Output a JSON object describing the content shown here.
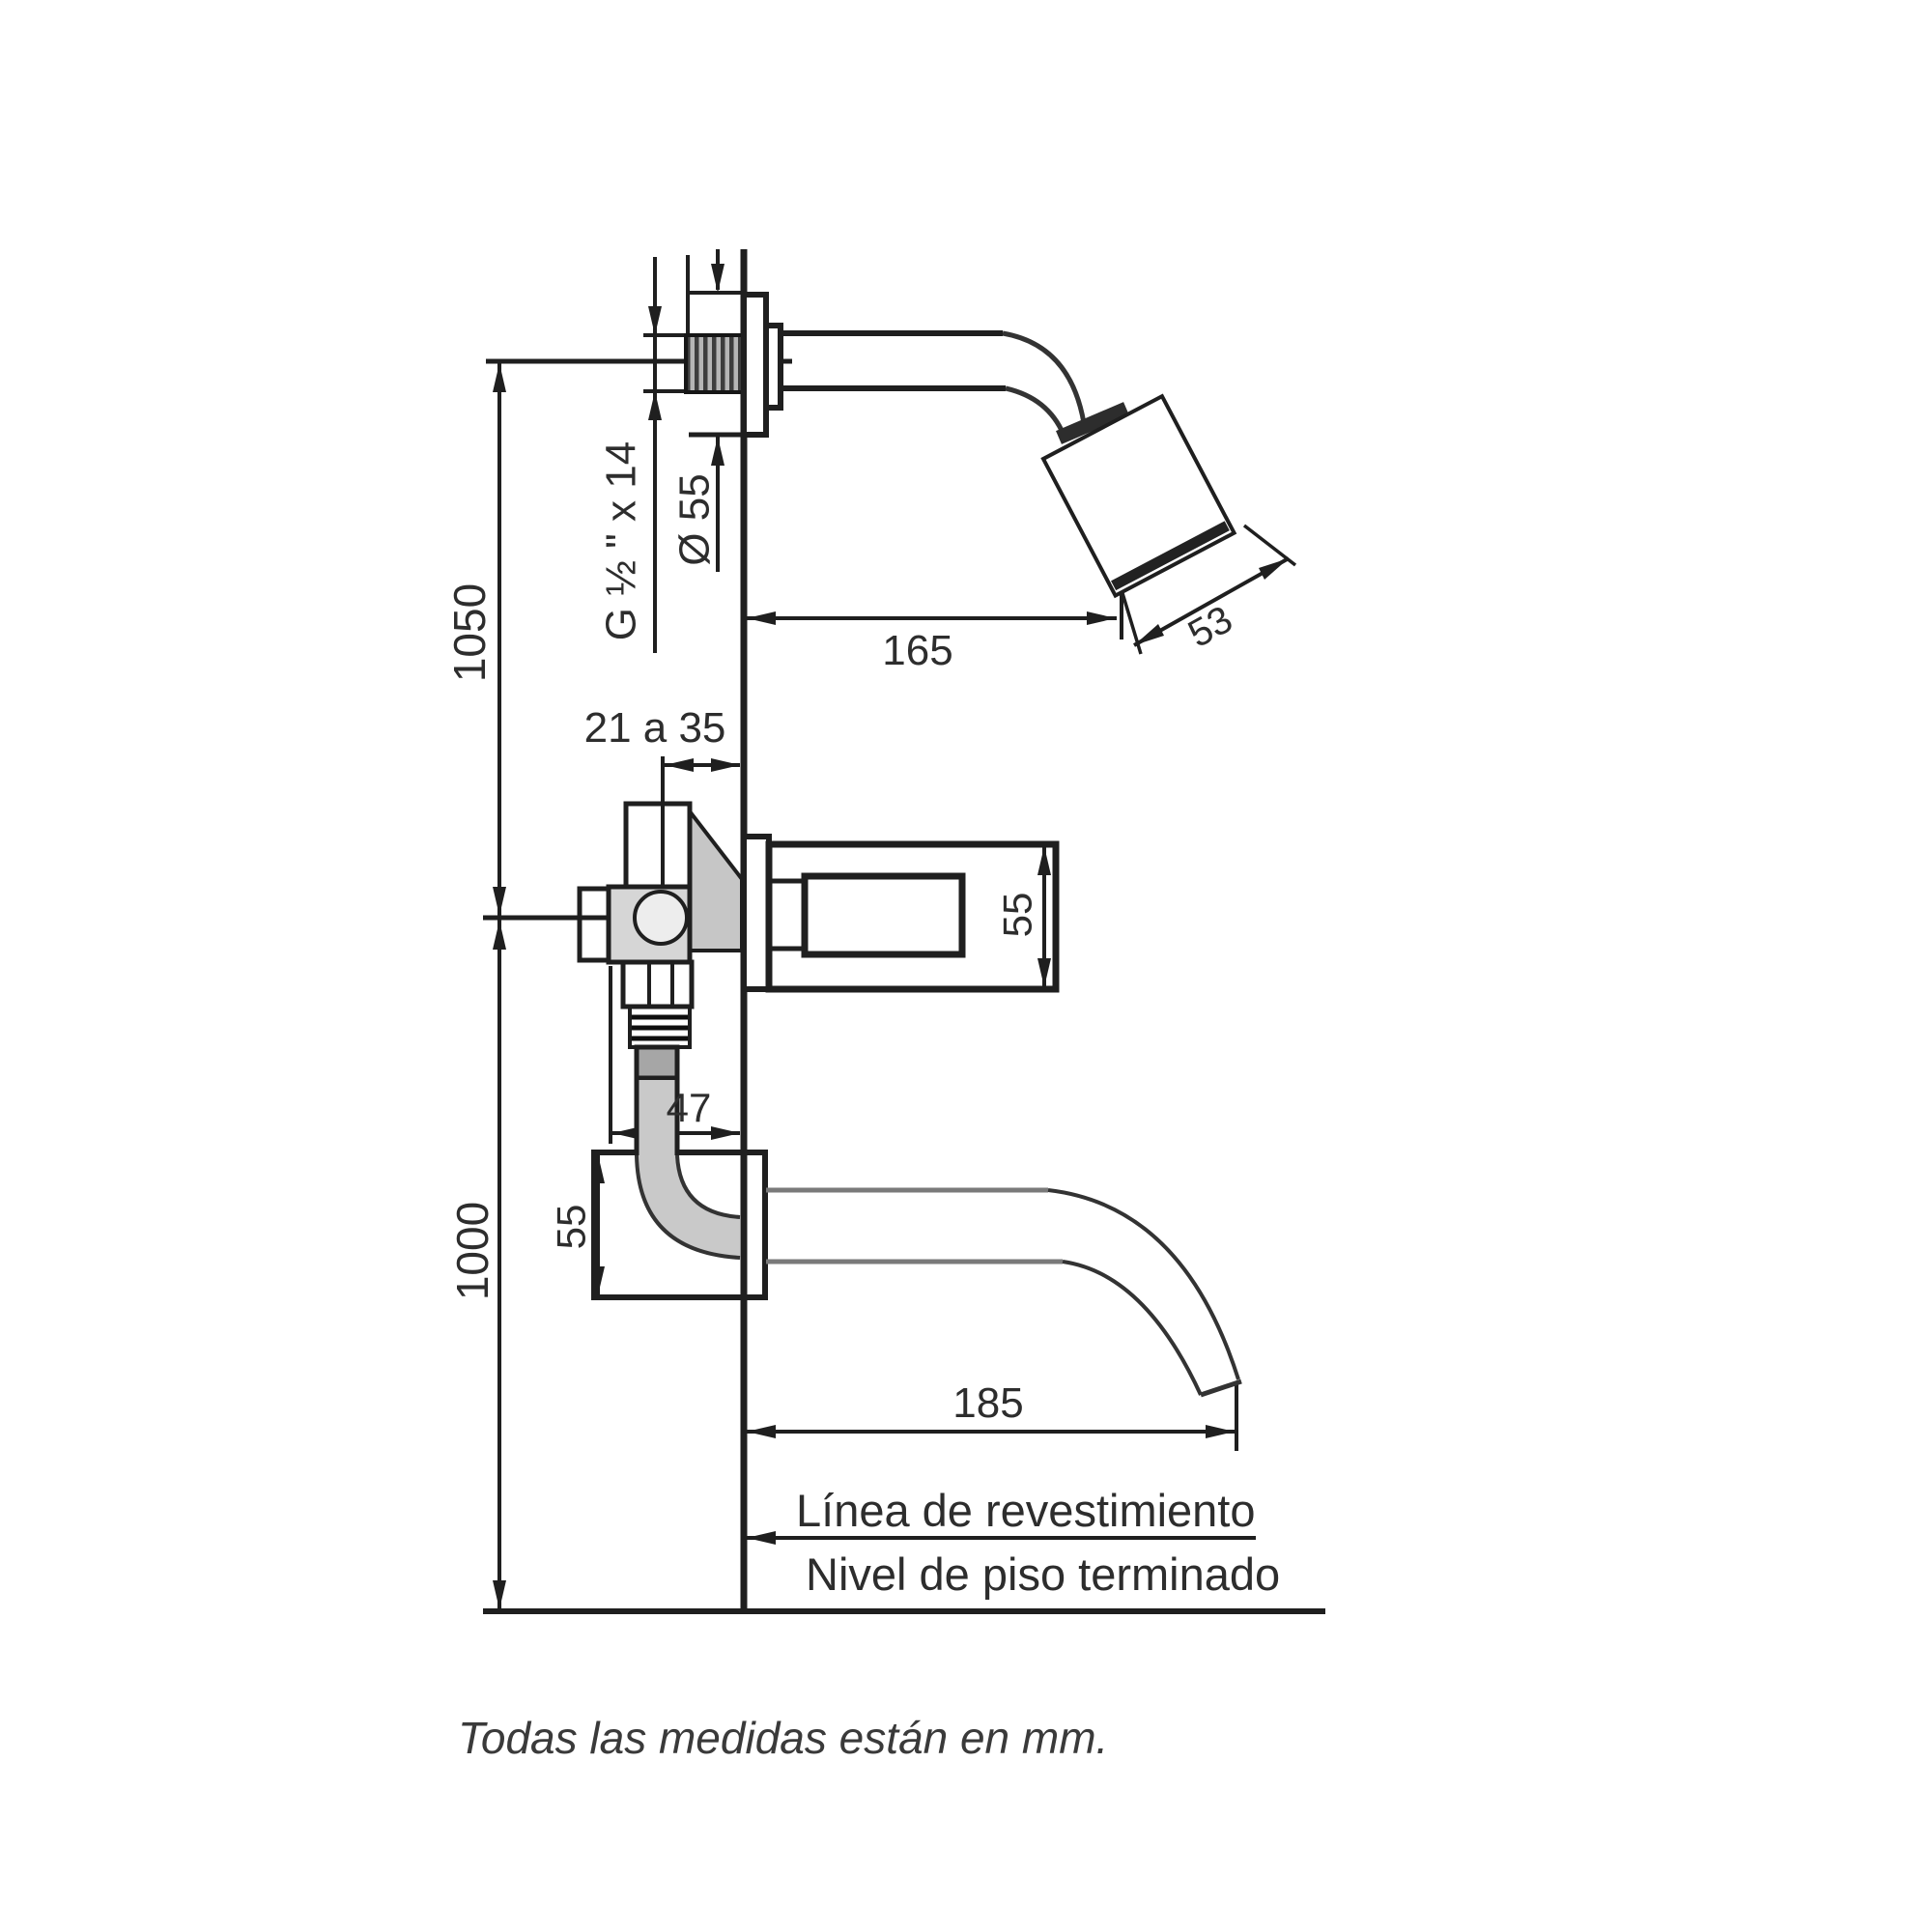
{
  "diagram": {
    "kind": "technical-installation-drawing",
    "background": "#ffffff",
    "line_color": "#1f1f1f",
    "note": "Todas las medidas están en mm.",
    "dimensions": {
      "thread_spec": "G ½ \" x 14",
      "escutcheon_diameter": "Ø 55",
      "upper_height": "1050",
      "wall_embed_range": "21 a 35",
      "shower_arm_reach": "165",
      "shower_head_face": "53",
      "handle_height": "55",
      "valve_elbow_offset": "47",
      "elbow_box_height": "55",
      "lower_height": "1000",
      "spout_reach": "185"
    },
    "reference_lines": {
      "wall": "Línea de revestimiento",
      "floor": "Nivel de piso terminado"
    }
  }
}
